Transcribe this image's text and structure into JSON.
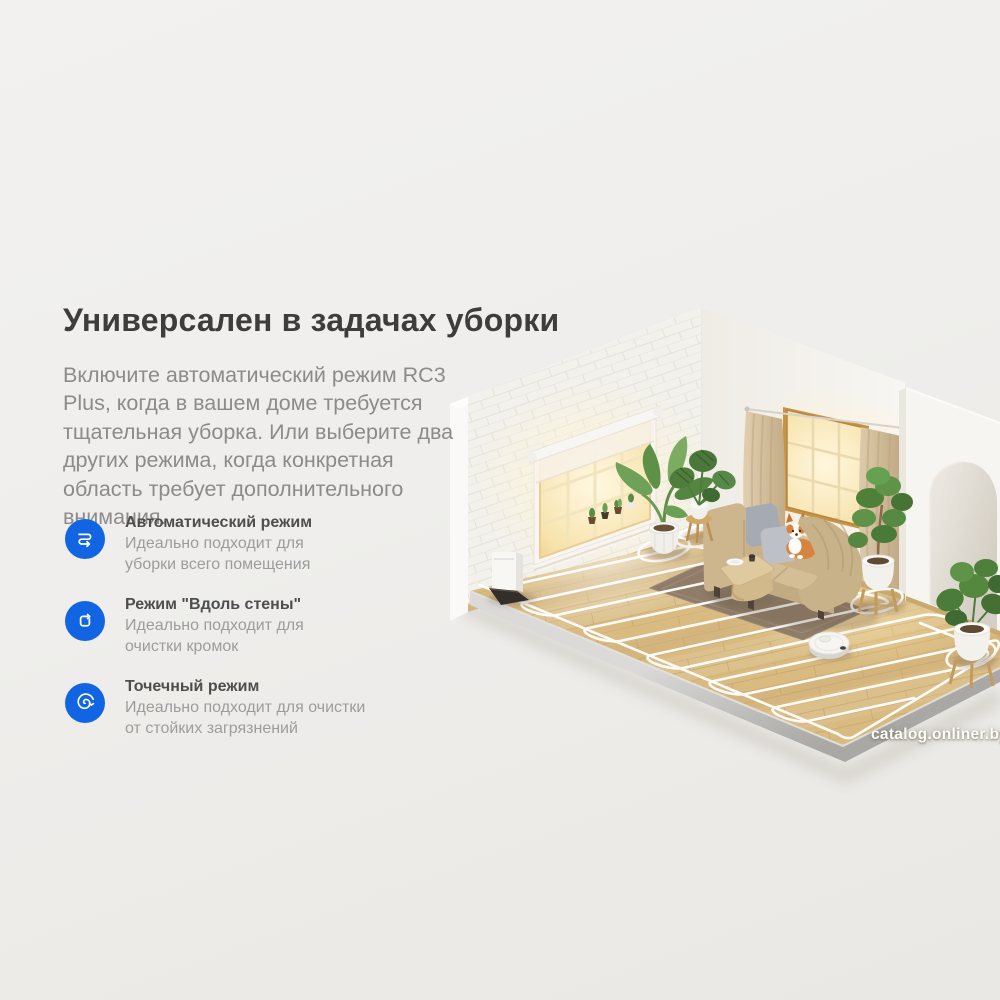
{
  "banner": {
    "title": "Универсален в задачах уборки",
    "description": "Включите автоматический режим RC3 Plus, когда в вашем доме требуется тщательная уборка. Или выберите два других режима, когда конкретная область требует дополнительного внимания."
  },
  "features": [
    {
      "icon": "serpentine-route-icon",
      "title": "Автоматический режим",
      "description": "Идеально подходит для уборки всего помещения"
    },
    {
      "icon": "wall-follow-icon",
      "title": "Режим \"Вдоль стены\"",
      "description": "Идеально подходит для очистки кромок"
    },
    {
      "icon": "spot-spiral-icon",
      "title": "Точечный режим",
      "description": "Идеально подходит для очистки от стойких загрязнений"
    }
  ],
  "watermark": "catalog.onliner.by",
  "colors": {
    "accent_blue": "#1165e3",
    "title_text": "#3d3d3d",
    "body_text": "#8b8b8b",
    "background": "#efeeec",
    "floor_wood": "#d9bb82",
    "cleaning_path": "#ffffff"
  }
}
